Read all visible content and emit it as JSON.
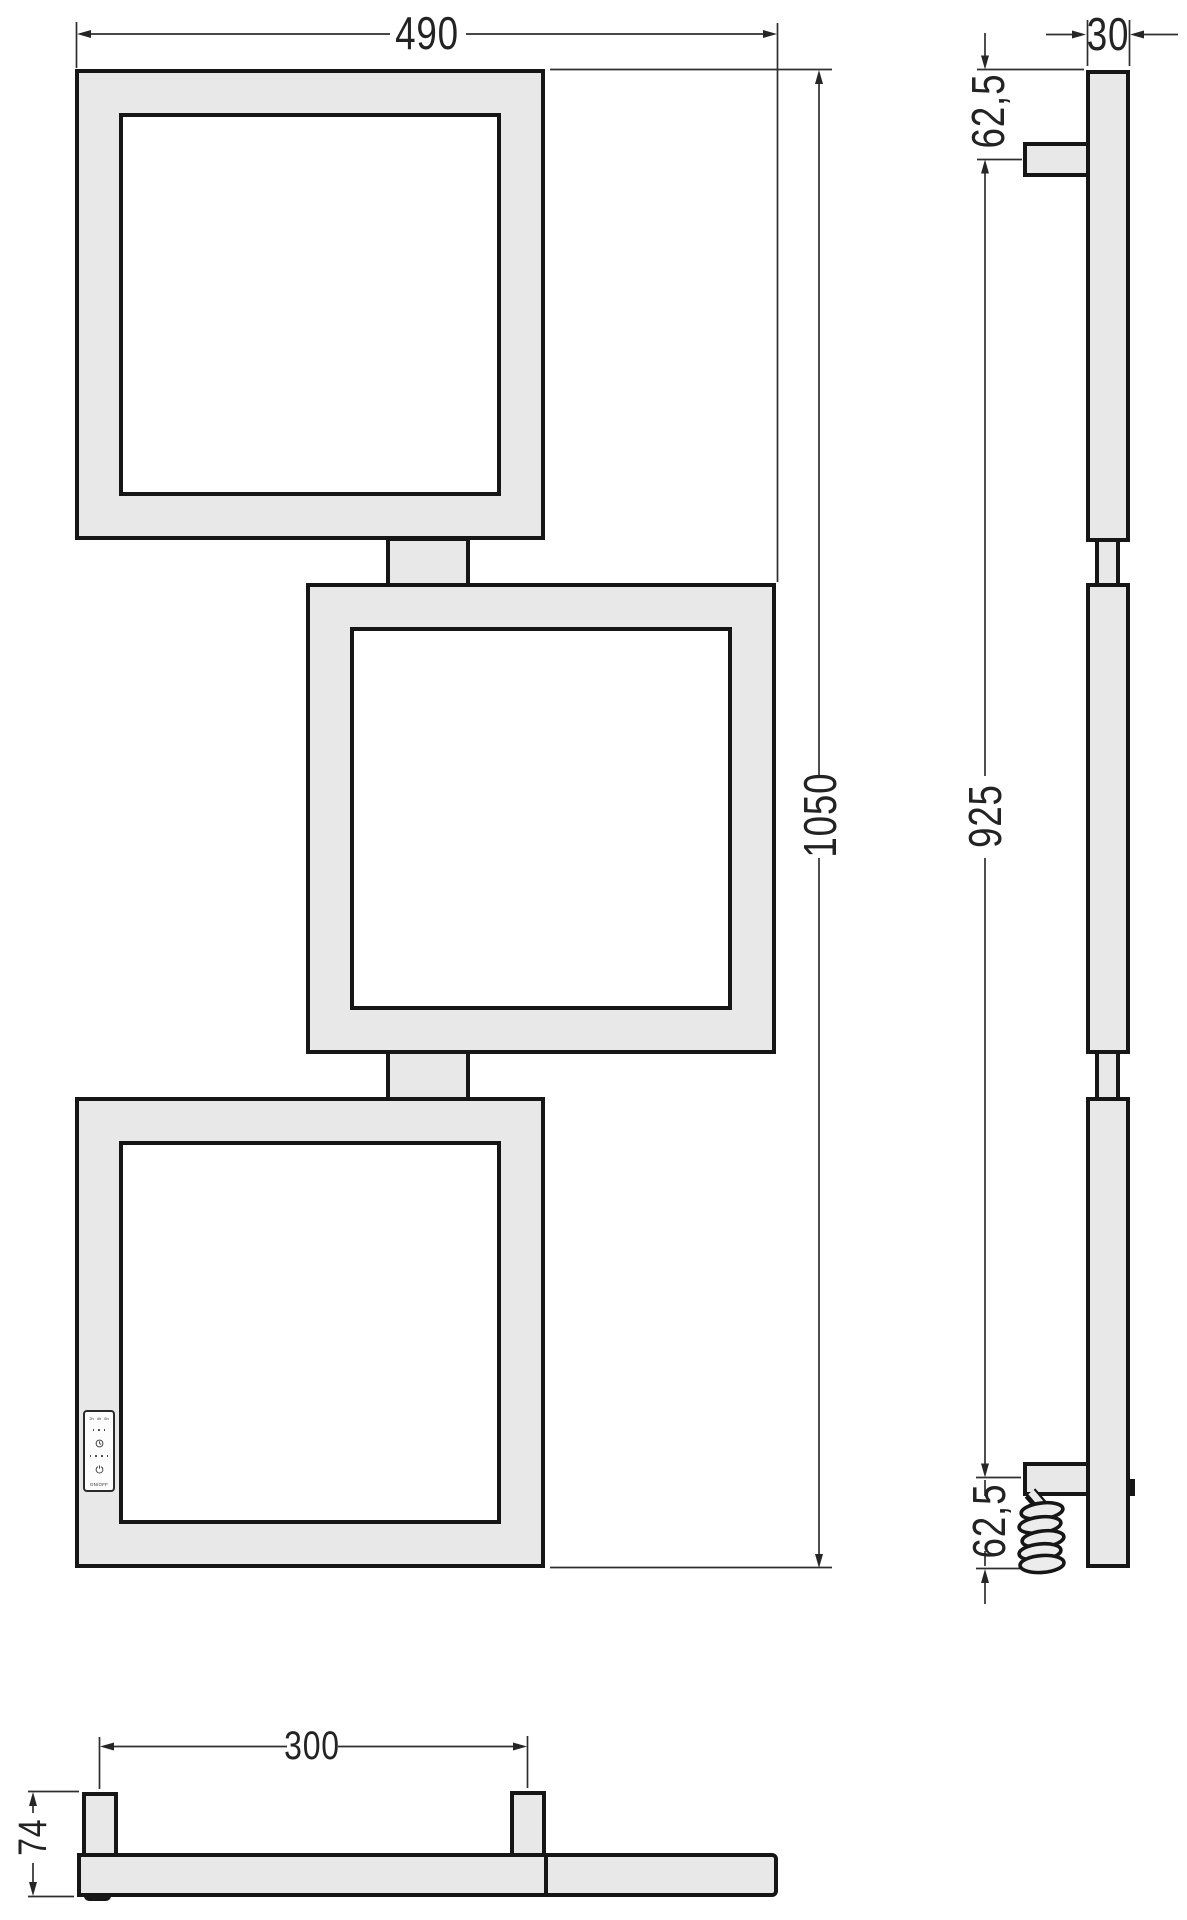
{
  "front_view": {
    "overall_width": "490",
    "overall_height": "1050"
  },
  "side_view": {
    "profile_depth": "30",
    "top_bracket_offset": "62,5",
    "bracket_span": "925",
    "bottom_bracket_offset": "62,5"
  },
  "bottom_view": {
    "bracket_spacing": "300",
    "overall_depth": "74"
  },
  "control_panel": {
    "timer_labels": [
      "2h",
      "4h",
      "6h"
    ],
    "power_label": "ON/OFF"
  },
  "colors": {
    "profile_fill": "#e8e8e8",
    "outline": "#161616",
    "dimension_lines": "#2f2f2f",
    "dimension_text": "#232323",
    "background": "#ffffff"
  }
}
